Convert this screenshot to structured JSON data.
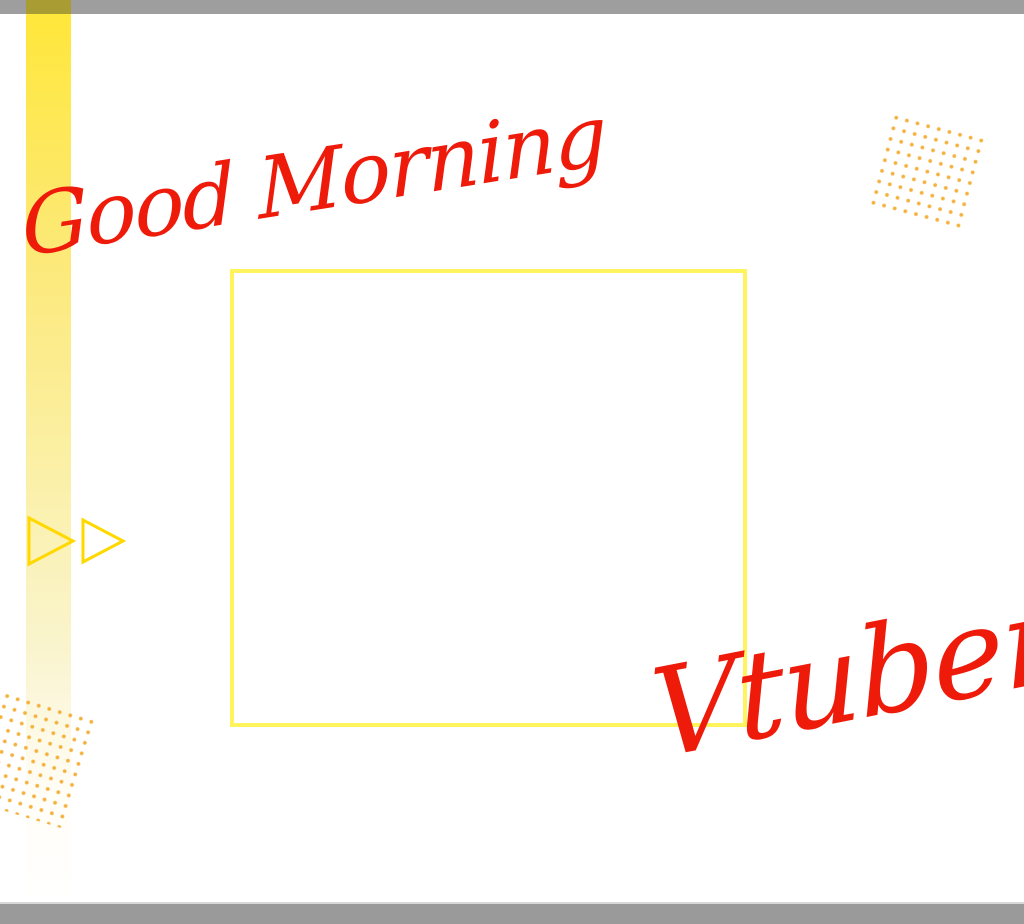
{
  "canvas": {
    "width_px": 1024,
    "height_px": 924,
    "background": "#FFFFFF"
  },
  "texts": {
    "greeting": "Good Morning",
    "subject": "Vtuber"
  },
  "colors": {
    "script_red": "#EE1B0B",
    "top_bar_gray": "#9E9E9E",
    "bottom_bar_gray": "#9A9A9A",
    "stripe_yellow_top": "#FFE73B",
    "stripe_bar_overlap_olive": "#A89C32",
    "frame_outline_yellow": "#FFF45E",
    "triangle_gold": "#FFD800",
    "dot_orange": "#F5B13D"
  },
  "decor": {
    "icons": {
      "play_triangles": "two right-pointing outlined triangles",
      "dot_grid_top_right": "rotated square grid of small orange dots",
      "dot_grid_bottom_left": "rotated square grid of small orange dots, clipped at left edge"
    },
    "frame": {
      "description": "empty pale-yellow outlined rectangle placeholder",
      "left_px": 230,
      "top_px": 269,
      "width_px": 517,
      "height_px": 458
    }
  }
}
